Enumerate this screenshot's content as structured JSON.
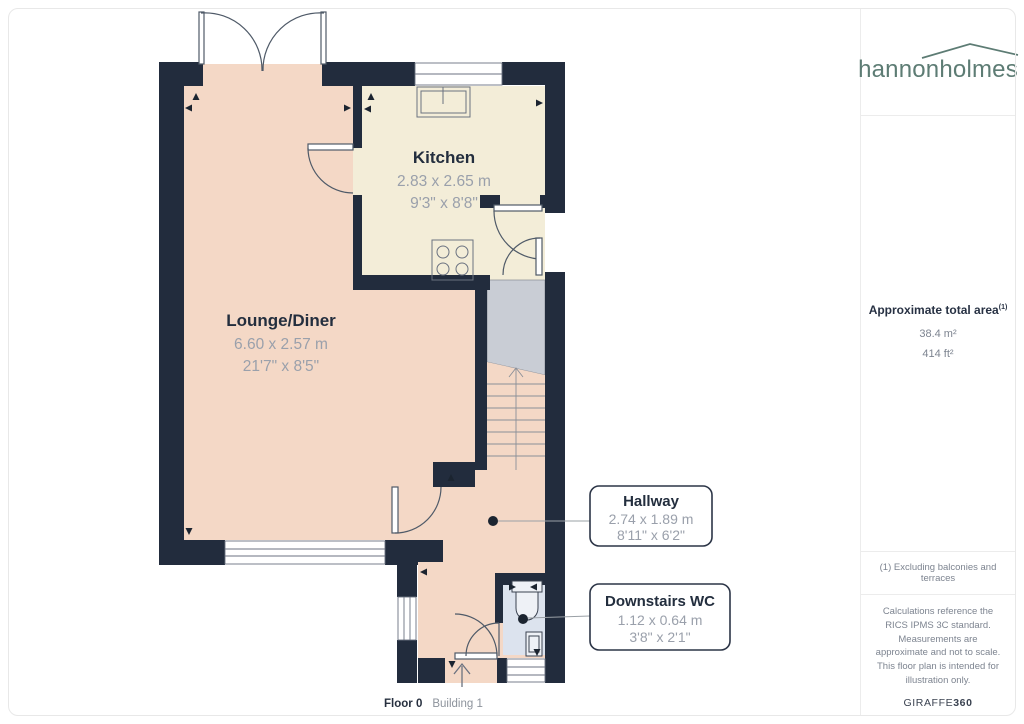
{
  "branding": {
    "logo_text_1": "hannon",
    "logo_text_2": "holmes",
    "logo_color": "#5d7c74"
  },
  "sidebar": {
    "area_title": "Approximate total area",
    "area_superscript": "(1)",
    "area_m2": "38.4 m²",
    "area_ft2": "414 ft²",
    "note": "(1) Excluding balconies and terraces",
    "disclaimer": "Calculations reference the RICS IPMS 3C standard. Measurements are approximate and not to scale. This floor plan is intended for illustration only.",
    "provider": "GIRAFFE",
    "provider_suffix": "360"
  },
  "footer": {
    "floor_label": "Floor 0",
    "building_label": "Building 1"
  },
  "floorplan": {
    "rooms": [
      {
        "name": "Kitchen",
        "metric": "2.83 x 2.65 m",
        "imperial": "9'3\" x 8'8\""
      },
      {
        "name": "Lounge/Diner",
        "metric": "6.60 x 2.57 m",
        "imperial": "21'7\" x 8'5\""
      },
      {
        "name": "Hallway",
        "metric": "2.74 x 1.89 m",
        "imperial": "8'11\" x 6'2\""
      },
      {
        "name": "Downstairs WC",
        "metric": "1.12 x 0.64 m",
        "imperial": "3'8\" x 2'1\""
      }
    ],
    "colors": {
      "wall": "#222c3d",
      "lounge_floor": "#f4d8c6",
      "kitchen_floor": "#f3edd8",
      "stairs_landing": "#c9cdd5",
      "wc_floor": "#dce3ee",
      "symbol_line": "#4f5a68",
      "dim_text": "#9aa0ab",
      "room_text": "#232e3e"
    }
  }
}
